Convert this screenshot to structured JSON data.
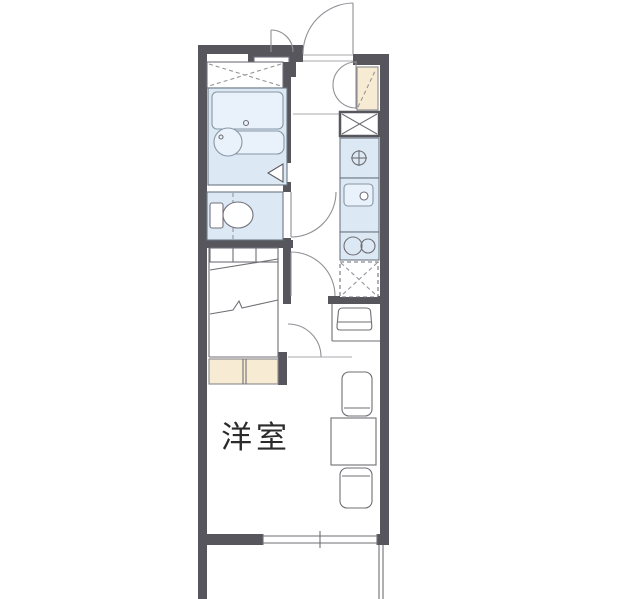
{
  "floor_plan": {
    "room_label": "洋室",
    "colors": {
      "bg": "#ffffff",
      "wall": "#56565c",
      "line": "#6f6f75",
      "fixture": "#dce9f4",
      "fixture_light": "#e9f2fb",
      "beige": "#f7ecd3",
      "dash": "#95959b",
      "text": "#2b2b2b"
    },
    "symbols": {
      "bathtub": "rounded-rect with drain dot",
      "bath-sink": "circle with faucet dot",
      "toilet": "tank rectangle + bowl ellipse",
      "water-heater": "square with crossed circle",
      "kitchen-sink": "rounded rect with faucet circle",
      "stove": "two burner circles",
      "refrigerator-space": "dashed box with dashed X",
      "washer-space": "box with solid X",
      "upper-closet": "dashed X area",
      "shoe-cabinet": "beige box with dashed diagonal and double swing arcs",
      "loft-bed": "shelf row with break lines",
      "window": "double line with ticks",
      "door": "quarter-circle swing arc"
    }
  }
}
